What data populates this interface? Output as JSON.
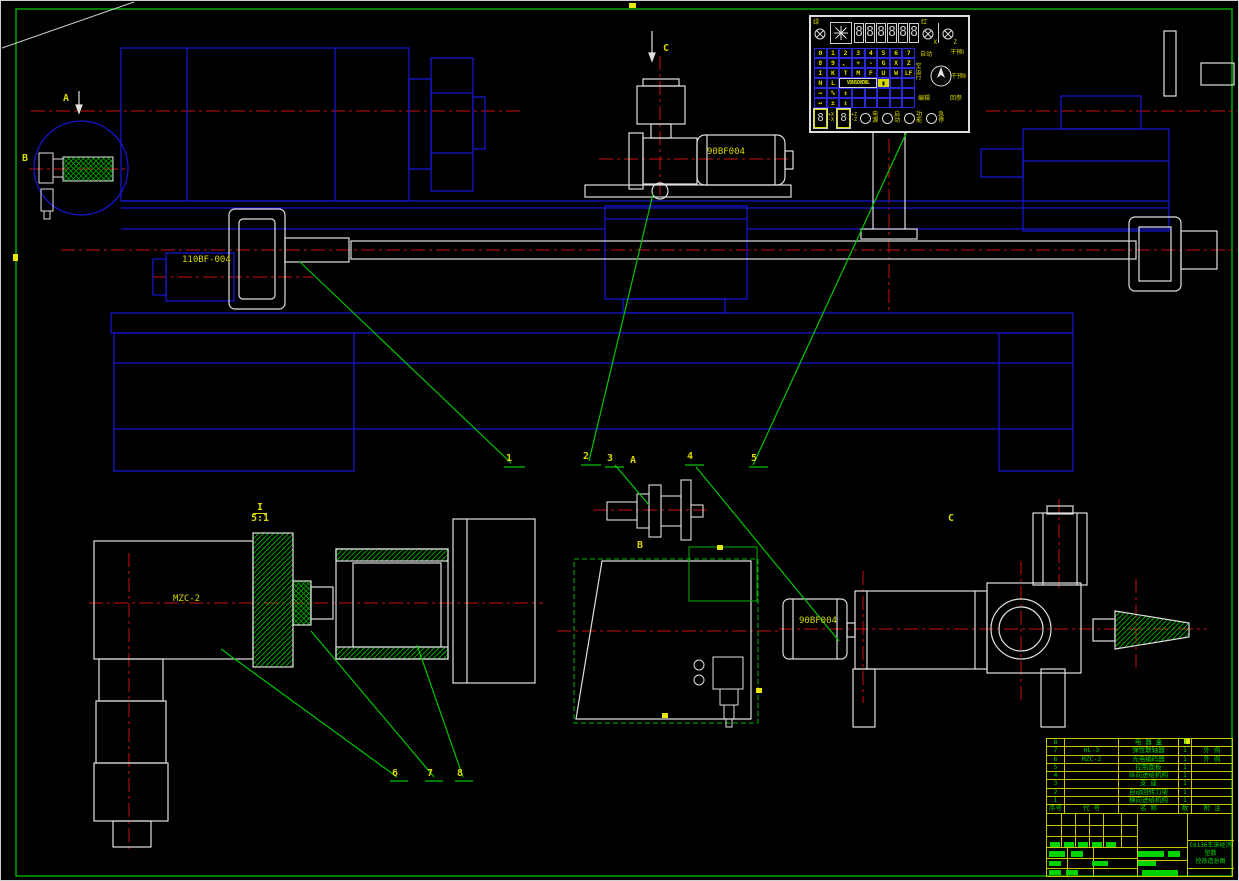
{
  "labels": {
    "view_a_top": "A",
    "view_b_left": "B",
    "view_c_top": "C",
    "view_a_mid": "A",
    "view_b_mid": "B",
    "view_c_mid": "C",
    "motor_top": "90BF004",
    "motor_c": "90BF004",
    "feed_unit": "110BF-004",
    "encoder": "MZC-2",
    "detail_mark": "I",
    "detail_scale": "5:1"
  },
  "balloons": [
    "1",
    "2",
    "3",
    "4",
    "5",
    "6",
    "7",
    "8"
  ],
  "panel": {
    "lamps": {
      "green": "绿",
      "red": "红",
      "axis_x": "X",
      "axis_z": "Z"
    },
    "display_digits": [
      "8",
      "8",
      "8",
      "8",
      "8",
      "8"
    ],
    "keyboard_cells": [
      {
        "t": "0"
      },
      {
        "t": "1"
      },
      {
        "t": "2"
      },
      {
        "t": "3"
      },
      {
        "t": "4"
      },
      {
        "t": "5"
      },
      {
        "t": "6"
      },
      {
        "t": "7"
      },
      {
        "t": "8"
      },
      {
        "t": "9"
      },
      {
        "t": "、"
      },
      {
        "t": "+"
      },
      {
        "t": "-"
      },
      {
        "t": "G"
      },
      {
        "t": "X"
      },
      {
        "t": "Z"
      },
      {
        "t": "I"
      },
      {
        "t": "K"
      },
      {
        "t": "T"
      },
      {
        "t": "M"
      },
      {
        "t": "F"
      },
      {
        "t": "U"
      },
      {
        "t": "W"
      },
      {
        "t": "LF"
      },
      {
        "t": "N"
      },
      {
        "t": "L"
      },
      {
        "t": "VONSOHDBL",
        "cls": "wide"
      },
      {
        "t": "▮",
        "cls": "cursor"
      },
      {
        "t": ""
      },
      {
        "t": ""
      },
      {
        "t": "→"
      },
      {
        "t": "%"
      },
      {
        "t": "↕"
      },
      {
        "t": ""
      },
      {
        "t": ""
      },
      {
        "t": ""
      },
      {
        "t": ""
      },
      {
        "t": ""
      },
      {
        "t": "↔"
      },
      {
        "t": "±"
      },
      {
        "t": "↕"
      },
      {
        "t": ""
      },
      {
        "t": ""
      },
      {
        "t": ""
      },
      {
        "t": ""
      },
      {
        "t": ""
      }
    ],
    "selector": [
      "自动",
      "干预Ⅰ",
      "空运行",
      "干预Ⅱ",
      "编辑",
      "回参"
    ],
    "axis_displays": [
      {
        "digit": "8",
        "plus": "+X",
        "minus": "-X"
      },
      {
        "digit": "8",
        "plus": "+Z",
        "minus": "-Z"
      }
    ],
    "buttons": [
      "电源",
      "启动",
      "功能",
      "急停"
    ]
  },
  "bom": {
    "headers": [
      "序号",
      "代  号",
      "名  称",
      "数量",
      "附  注"
    ],
    "rows": [
      {
        "seq": "8",
        "code": "",
        "name": "电 器 盒",
        "qty": "1",
        "note": ""
      },
      {
        "seq": "7",
        "code": "HL-3",
        "name": "弹性联轴器",
        "qty": "1",
        "note": "外  购"
      },
      {
        "seq": "6",
        "code": "MZC-2",
        "name": "光电编码器",
        "qty": "1",
        "note": "外  购"
      },
      {
        "seq": "5",
        "code": "",
        "name": "控制面板",
        "qty": "1",
        "note": ""
      },
      {
        "seq": "4",
        "code": "",
        "name": "纵向进给机构",
        "qty": "1",
        "note": ""
      },
      {
        "seq": "3",
        "code": "",
        "name": "支  座",
        "qty": "1",
        "note": ""
      },
      {
        "seq": "2",
        "code": "",
        "name": "自动回转刀架",
        "qty": "1",
        "note": ""
      },
      {
        "seq": "1",
        "code": "",
        "name": "横向进给机构",
        "qty": "1",
        "note": ""
      }
    ]
  },
  "title": {
    "line1": "C6136车床经济型数",
    "line2": "控改造总图"
  }
}
